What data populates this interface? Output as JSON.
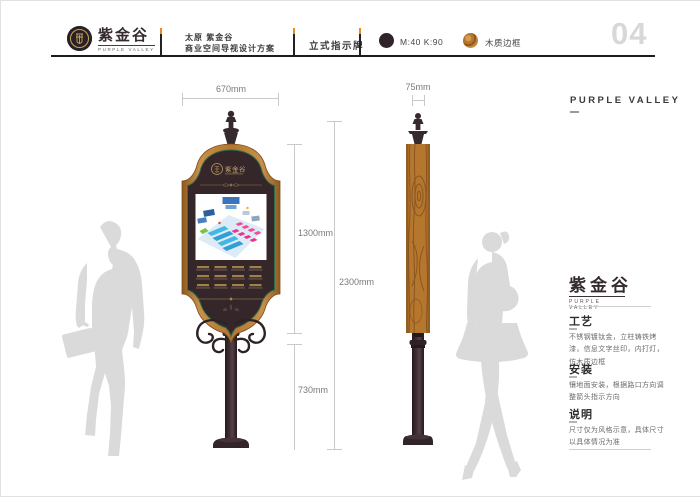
{
  "page": {
    "number": "04"
  },
  "header": {
    "logo": {
      "brand_cn": "紫金谷",
      "brand_en": "PURPLE VALLEY"
    },
    "project": {
      "line1": "太原 紫金谷",
      "line2": "商业空间导视设计方案"
    },
    "sheet_title": "立式指示牌",
    "swatches": [
      {
        "name": "sign-body-color",
        "label": "M:40 K:90",
        "color": "#30242a"
      },
      {
        "name": "wood-frame",
        "label": "木质边框",
        "color": "#b5762e"
      }
    ]
  },
  "drawings": {
    "front": {
      "width_label": "670mm",
      "panel_height_label": "1300mm",
      "total_height_label": "2300mm",
      "pole_height_label": "730mm",
      "sign_brand": "紫金谷",
      "directory": {
        "rows": 3,
        "columns": 4
      }
    },
    "side": {
      "width_label": "75mm"
    }
  },
  "sidebar": {
    "top_title": "PURPLE VALLEY",
    "logo": {
      "brand_cn": "紫金谷",
      "brand_en": "PURPLE VALLEY"
    },
    "sections": [
      {
        "heading": "工艺",
        "body": "不锈钢镀钛金，立柱铸铁烤漆，信息文字丝印，内打灯，仿木质边框"
      },
      {
        "heading": "安装",
        "body": "镶地面安装，根据路口方向调整箭头指示方向"
      },
      {
        "heading": "说明",
        "body": "尺寸仅为风格示意，具体尺寸以具体情况为准"
      }
    ]
  },
  "colors": {
    "accent_orange": "#ed8a1e",
    "sign_dark": "#35262a",
    "wood": "#b5762e",
    "green_trim": "#2f6e4e",
    "gold": "#bfa05e",
    "silhouette": "#dadada"
  }
}
